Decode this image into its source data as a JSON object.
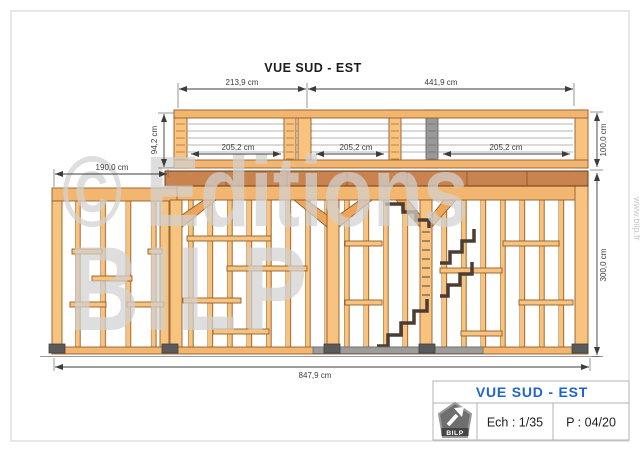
{
  "drawing": {
    "title": "VUE SUD - EST",
    "dims": {
      "top_left": "213,9 cm",
      "top_right": "441,9 cm",
      "balustrade_height": "94,2 cm",
      "guardrail_height": "100,0 cm",
      "left_wall_width": "190,0 cm",
      "bay_1": "205,2 cm",
      "bay_2": "205,2 cm",
      "bay_3": "205,2 cm",
      "wall_height": "300,0 cm",
      "total_width": "847,9 cm"
    },
    "watermark": {
      "line1": "© Editions",
      "line2": "BILP",
      "website": "www.bilp.fr"
    }
  },
  "title_block": {
    "view_title": "VUE SUD - EST",
    "scale": "Ech : 1/35",
    "page": "P : 04/20",
    "logo": "BILP"
  },
  "colors": {
    "accent_blue": "#1e63cf",
    "wood_light": "#f8c37e",
    "wood_dark": "#c8834e",
    "metal_gray": "#9c9c9c",
    "watermark_gray": "#d2d2d2"
  }
}
